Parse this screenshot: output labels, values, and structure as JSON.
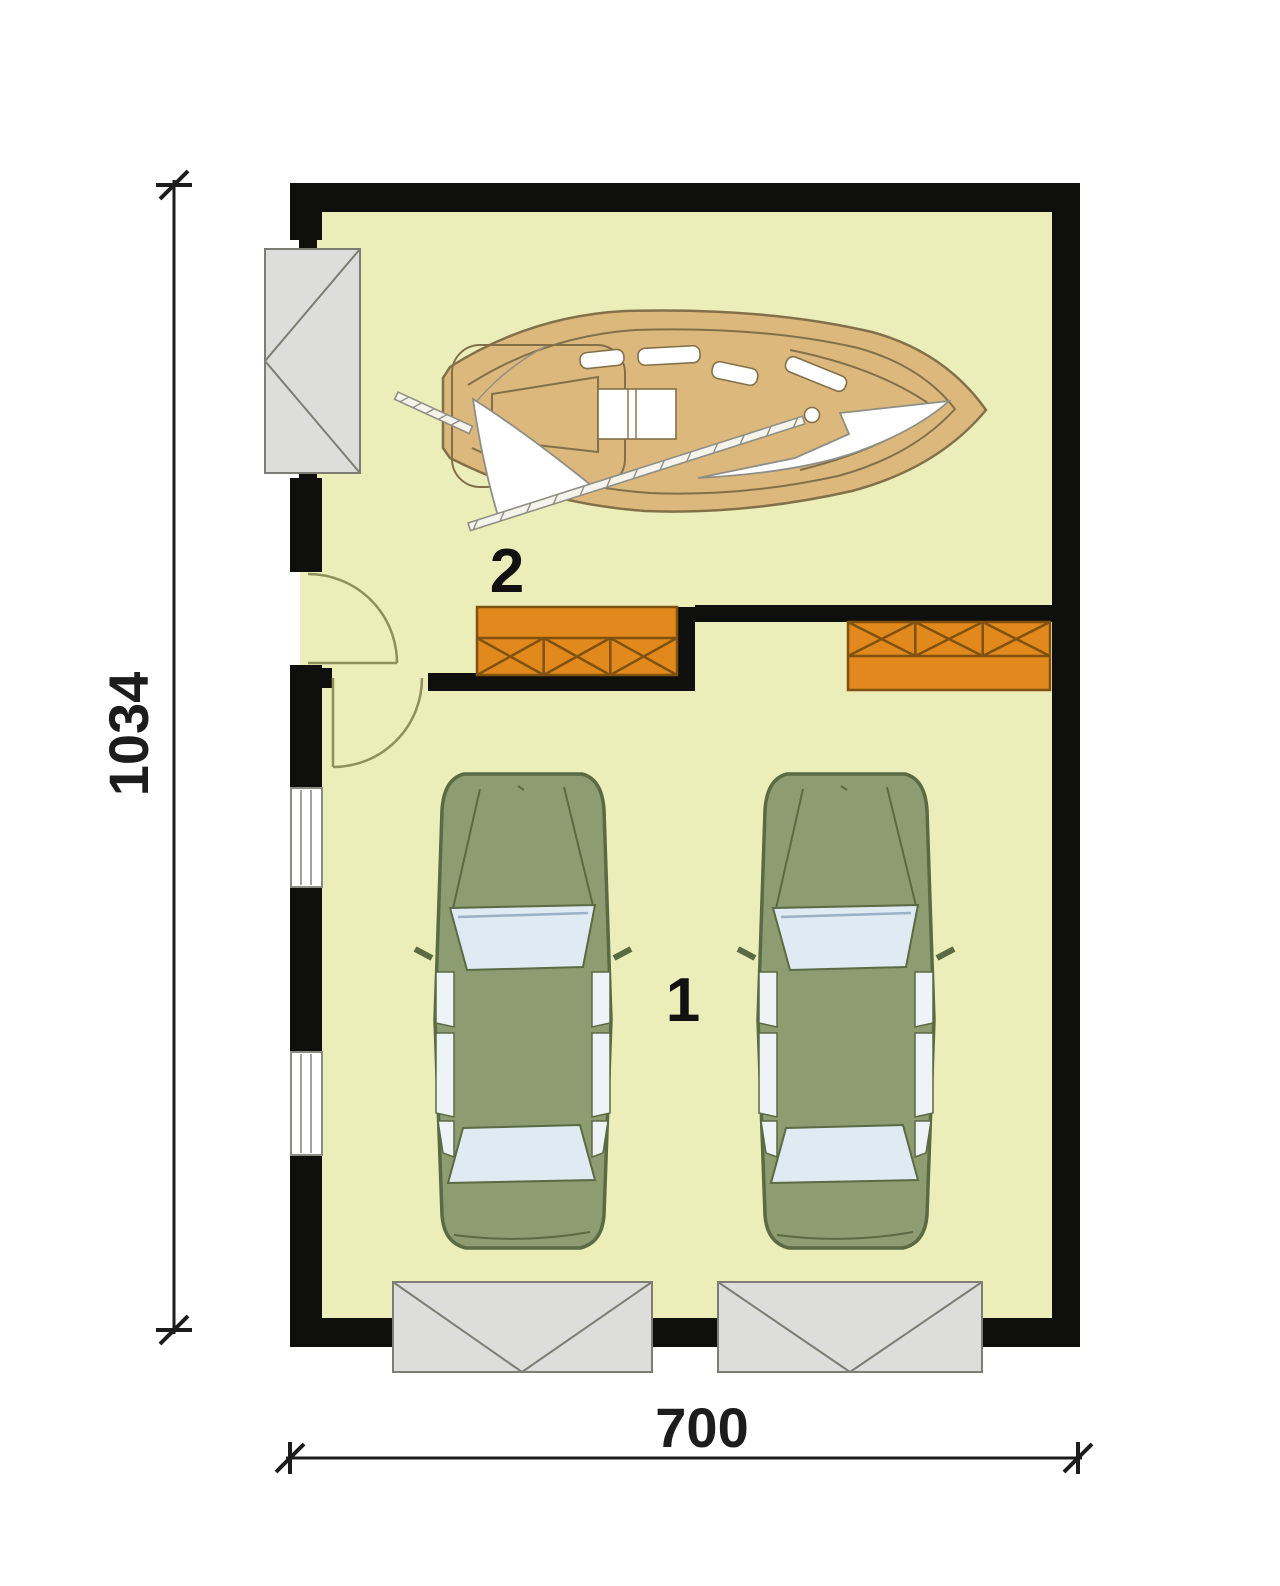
{
  "floor_plan": {
    "dimensions": {
      "width": "700",
      "height": "1034"
    },
    "rooms": [
      {
        "label": "1"
      },
      {
        "label": "2"
      }
    ],
    "colors": {
      "floor": "#ebeeb8",
      "wall": "#0f0f0d",
      "beam": "#e1891d",
      "beam-line": "#80510f",
      "boat-hull": "#ddb87c",
      "boat-outline": "#82704a",
      "car-body": "#8e9c72",
      "car-outline": "#5a6a42",
      "glass": "#dfeaf2",
      "side-glass": "#eef3f7",
      "door-panel": "#dddddb",
      "door-outline": "#7d7d76",
      "swing": "#8f8f5a",
      "window-frame": "#8b8b85",
      "dim": "#1c1c1c",
      "spar": "#8f8f85"
    }
  }
}
